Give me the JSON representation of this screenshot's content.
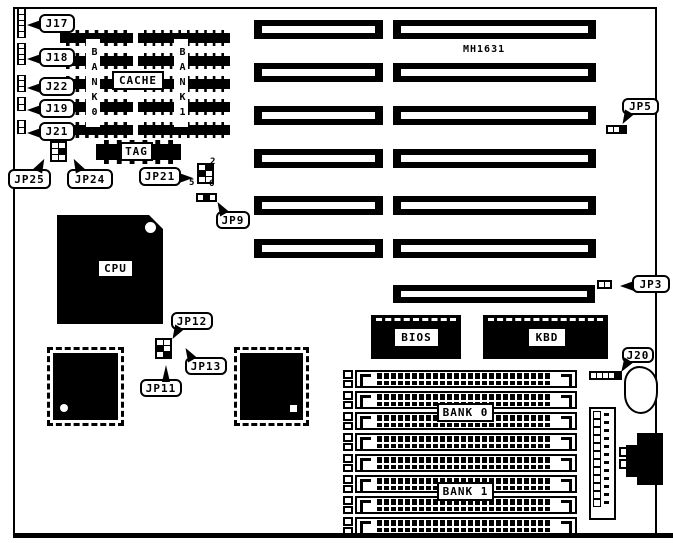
{
  "board": {
    "model": "MH1631"
  },
  "callouts": {
    "j17": "J17",
    "j18": "J18",
    "j22": "J22",
    "j19": "J19",
    "j21": "J21",
    "jp25": "JP25",
    "jp24": "JP24",
    "jp21": "JP21",
    "jp9": "JP9",
    "jp12": "JP12",
    "jp13": "JP13",
    "jp11": "JP11",
    "jp5": "JP5",
    "jp3": "JP3",
    "j20": "J20"
  },
  "labels": {
    "cpu": "CPU",
    "cache": "CACHE",
    "tag": "TAG",
    "bios": "BIOS",
    "kbd": "KBD",
    "cache_bank0": "BANK0",
    "cache_bank1": "BANK1",
    "simm_bank0": "BANK 0",
    "simm_bank1": "BANK 1"
  },
  "pin_labels": {
    "jp21_pin2": "2",
    "jp21_pin5": "5",
    "jp21_pin6": "6"
  },
  "colors": {
    "ink": "#000000",
    "paper": "#ffffff"
  }
}
